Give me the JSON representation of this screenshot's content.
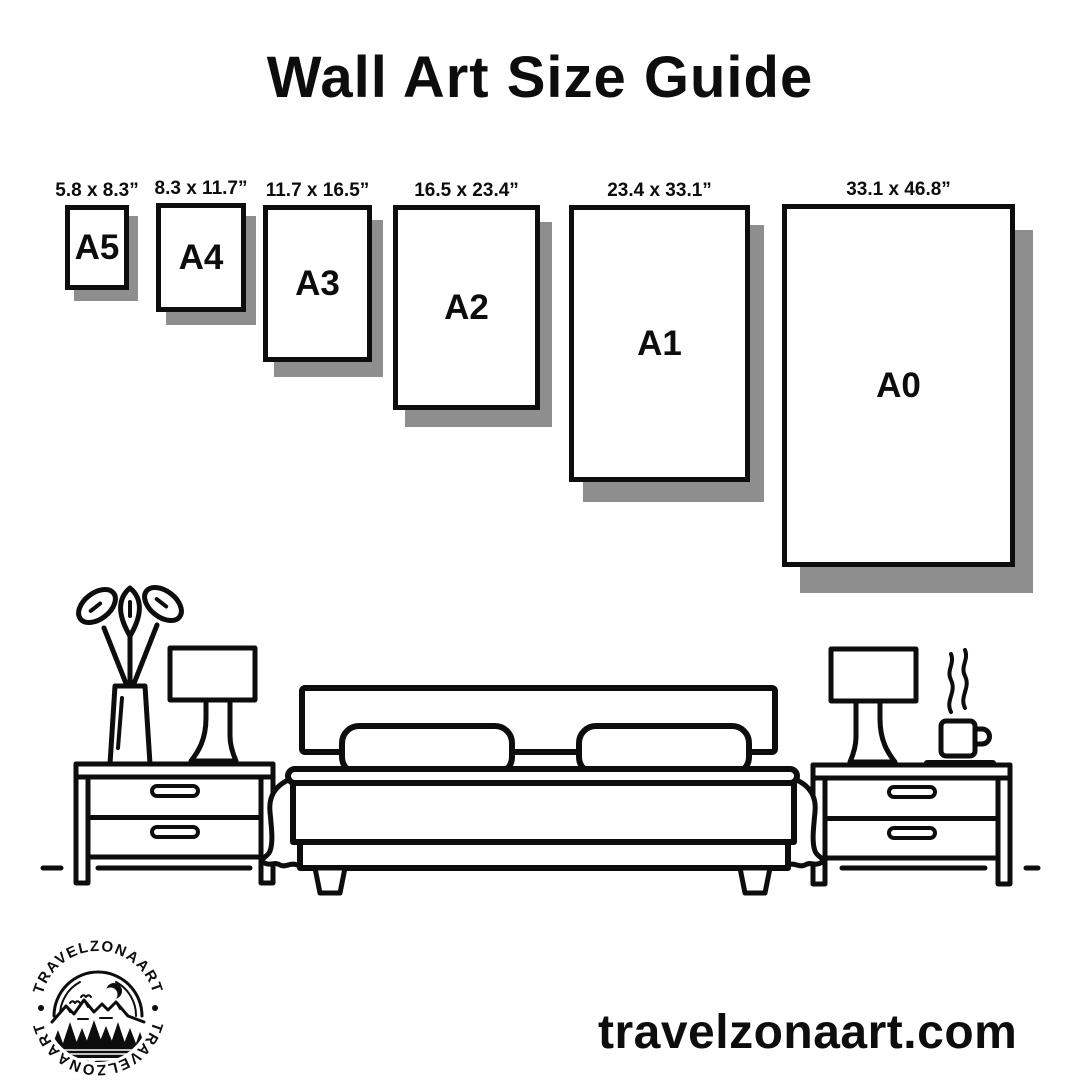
{
  "page": {
    "title": "Wall Art Size Guide"
  },
  "size_guide": {
    "sizes": [
      {
        "name": "A5",
        "dimensions": "5.8 x 8.3”"
      },
      {
        "name": "A4",
        "dimensions": "8.3 x 11.7”"
      },
      {
        "name": "A3",
        "dimensions": "11.7 x 16.5”"
      },
      {
        "name": "A2",
        "dimensions": "16.5 x 23.4”"
      },
      {
        "name": "A1",
        "dimensions": "23.4 x 33.1”"
      },
      {
        "name": "A0",
        "dimensions": "33.1 x 46.8”"
      }
    ]
  },
  "illustration": {
    "elements": [
      "plant-vase",
      "table-lamp-left",
      "nightstand-left",
      "bed-with-two-pillows",
      "blanket-drapes",
      "table-lamp-right",
      "steaming-coffee-cup",
      "nightstand-right",
      "floor-line"
    ]
  },
  "logo": {
    "text_top": "TRAVELZONAART",
    "text_bottom": "TRAVELZONAART"
  },
  "footer": {
    "website": "travelzonaart.com"
  },
  "colors": {
    "ink": "#0d0d0d",
    "paper_shadow": "#8e8e8e",
    "background": "#ffffff"
  }
}
